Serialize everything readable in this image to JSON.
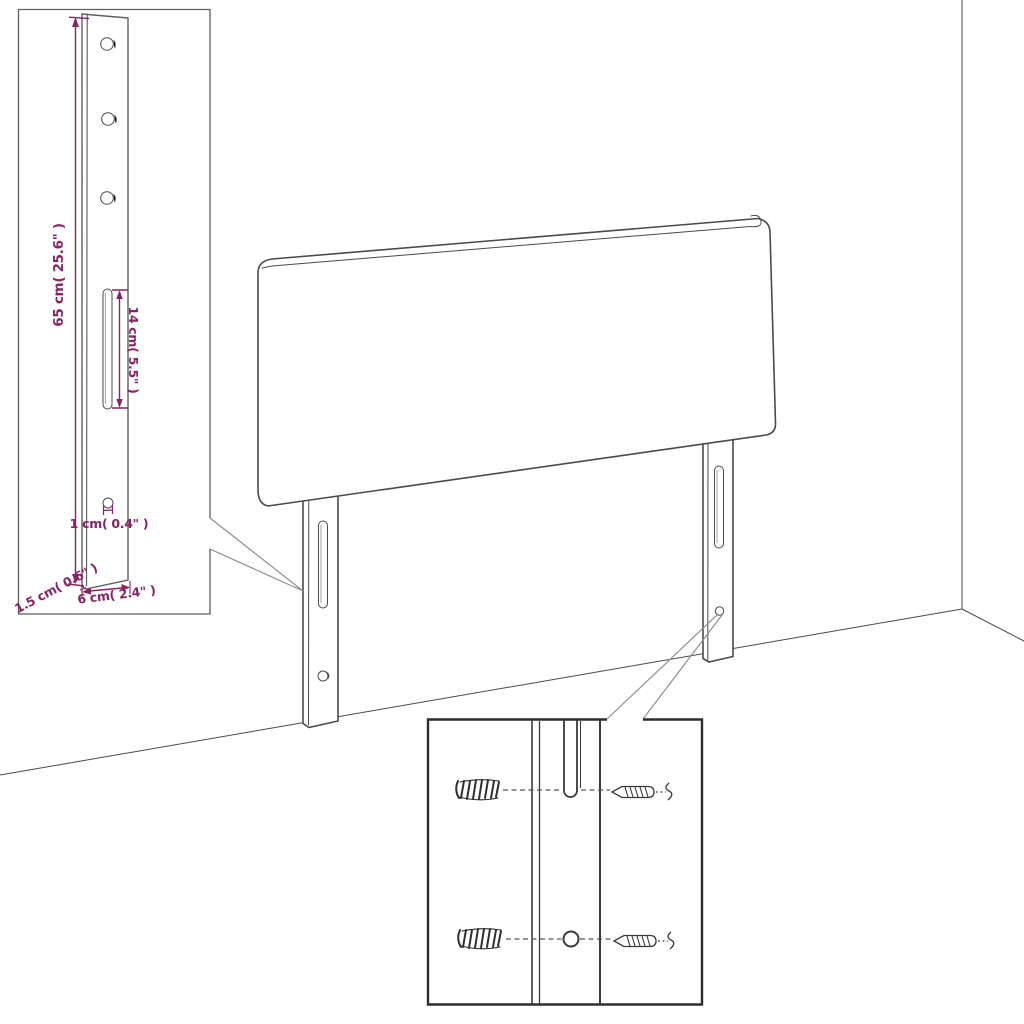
{
  "diagram": {
    "title_semantic": "headboard-with-legs-dimension-diagram",
    "labels": {
      "height": "65 cm( 25.6\" )",
      "slot": "14 cm( 5.5\" )",
      "hole": "1 cm( 0.4\" )",
      "depth": "1.5 cm( 0.6\" )",
      "width": "6 cm( 2.4\" )"
    },
    "colors": {
      "dimension": "#8B2262",
      "line": "#4a4a4a"
    },
    "icons": [
      "wall-anchor-icon",
      "screw-icon",
      "mounting-slot",
      "mounting-hole"
    ]
  }
}
